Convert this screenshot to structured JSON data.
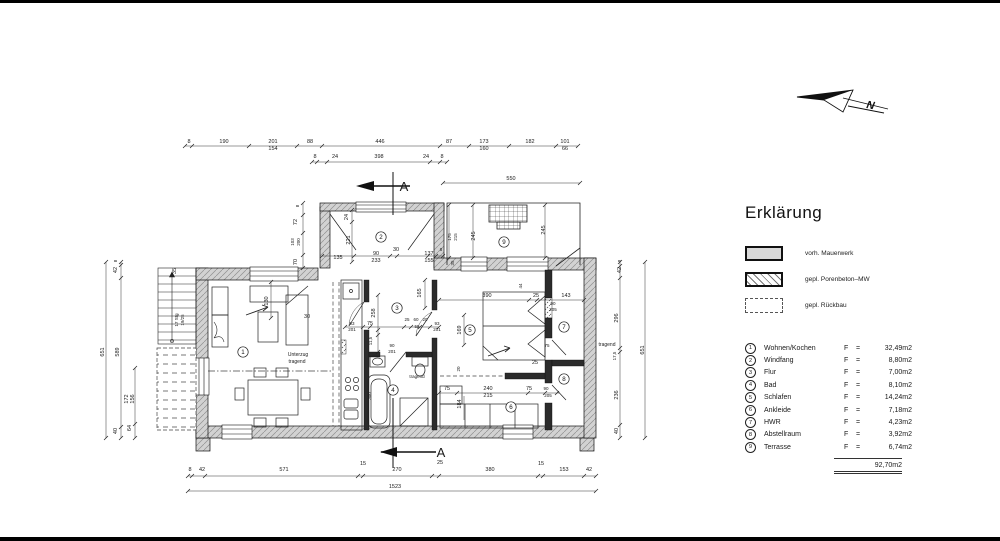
{
  "legend": {
    "title": "Erklärung",
    "items": [
      {
        "key": "vorh-mauerwerk",
        "style": "solid",
        "label": "vorh. Mauerwerk"
      },
      {
        "key": "gepl-porenbeton",
        "style": "hatched",
        "label": "gepl. Porenbeton–MW"
      },
      {
        "key": "gepl-rueckbau",
        "style": "dashed",
        "label": "gepl. Rückbau"
      }
    ],
    "rooms": [
      {
        "num": "1",
        "name": "Wohnen/Kochen",
        "f": "F",
        "eq": "=",
        "area": "32,49m2"
      },
      {
        "num": "2",
        "name": "Windfang",
        "f": "F",
        "eq": "=",
        "area": "8,80m2"
      },
      {
        "num": "3",
        "name": "Flur",
        "f": "F",
        "eq": "=",
        "area": "7,00m2"
      },
      {
        "num": "4",
        "name": "Bad",
        "f": "F",
        "eq": "=",
        "area": "8,10m2"
      },
      {
        "num": "5",
        "name": "Schlafen",
        "f": "F",
        "eq": "=",
        "area": "14,24m2"
      },
      {
        "num": "6",
        "name": "Ankleide",
        "f": "F",
        "eq": "=",
        "area": "7,18m2"
      },
      {
        "num": "7",
        "name": "HWR",
        "f": "F",
        "eq": "=",
        "area": "4,23m2"
      },
      {
        "num": "8",
        "name": "Abstellraum",
        "f": "F",
        "eq": "=",
        "area": "3,92m2"
      },
      {
        "num": "9",
        "name": "Terrasse",
        "f": "F",
        "eq": "=",
        "area": "6,74m2"
      }
    ],
    "total": "92,70m2"
  },
  "north": {
    "label": "N"
  },
  "plan": {
    "room_markers": [
      {
        "n": "1",
        "x": 243,
        "y": 352
      },
      {
        "n": "2",
        "x": 381,
        "y": 237
      },
      {
        "n": "3",
        "x": 397,
        "y": 308
      },
      {
        "n": "4",
        "x": 393,
        "y": 390
      },
      {
        "n": "5",
        "x": 470,
        "y": 330
      },
      {
        "n": "6",
        "x": 511,
        "y": 407
      },
      {
        "n": "7",
        "x": 564,
        "y": 327
      },
      {
        "n": "8",
        "x": 564,
        "y": 379
      },
      {
        "n": "9",
        "x": 504,
        "y": 242
      }
    ],
    "labels": [
      {
        "t": "8",
        "x": 189,
        "y": 143
      },
      {
        "t": "190",
        "x": 224,
        "y": 143
      },
      {
        "t": "201",
        "x": 273,
        "y": 143
      },
      {
        "t": "154",
        "x": 273,
        "y": 150
      },
      {
        "t": "88",
        "x": 310,
        "y": 143
      },
      {
        "t": "446",
        "x": 380,
        "y": 143
      },
      {
        "t": "87",
        "x": 449,
        "y": 143
      },
      {
        "t": "173",
        "x": 484,
        "y": 143
      },
      {
        "t": "160",
        "x": 484,
        "y": 150
      },
      {
        "t": "182",
        "x": 530,
        "y": 143
      },
      {
        "t": "101",
        "x": 565,
        "y": 143
      },
      {
        "t": "66",
        "x": 565,
        "y": 150
      },
      {
        "t": "8",
        "x": 315,
        "y": 158
      },
      {
        "t": "24",
        "x": 335,
        "y": 158
      },
      {
        "t": "398",
        "x": 379,
        "y": 158
      },
      {
        "t": "24",
        "x": 426,
        "y": 158
      },
      {
        "t": "8",
        "x": 442,
        "y": 158
      },
      {
        "t": "550",
        "x": 511,
        "y": 180
      },
      {
        "t": "8",
        "x": 190,
        "y": 471
      },
      {
        "t": "42",
        "x": 202,
        "y": 471
      },
      {
        "t": "571",
        "x": 284,
        "y": 471
      },
      {
        "t": "15",
        "x": 363,
        "y": 465
      },
      {
        "t": "270",
        "x": 397,
        "y": 471
      },
      {
        "t": "25",
        "x": 440,
        "y": 464
      },
      {
        "t": "380",
        "x": 490,
        "y": 471
      },
      {
        "t": "15",
        "x": 541,
        "y": 465
      },
      {
        "t": "153",
        "x": 564,
        "y": 471
      },
      {
        "t": "42",
        "x": 589,
        "y": 471
      },
      {
        "t": "1523",
        "x": 395,
        "y": 488
      },
      {
        "t": "651",
        "x": 104,
        "y": 352,
        "r": -90
      },
      {
        "t": "42",
        "x": 117,
        "y": 270,
        "r": -90
      },
      {
        "t": "8",
        "x": 117,
        "y": 261,
        "r": -90,
        "s": 4.5
      },
      {
        "t": "589",
        "x": 119,
        "y": 352,
        "r": -90
      },
      {
        "t": "40",
        "x": 117,
        "y": 431,
        "r": -90
      },
      {
        "t": "172",
        "x": 128,
        "y": 399,
        "r": -90
      },
      {
        "t": "156",
        "x": 134,
        "y": 399,
        "r": -90
      },
      {
        "t": "64",
        "x": 131,
        "y": 428,
        "r": -90
      },
      {
        "t": "35",
        "x": 176,
        "y": 271,
        "r": -90
      },
      {
        "t": "17 Stg",
        "x": 178,
        "y": 320,
        "r": -90,
        "s": 4.5
      },
      {
        "t": "19/25",
        "x": 184,
        "y": 320,
        "r": -90,
        "s": 4.5
      },
      {
        "t": "42",
        "x": 621,
        "y": 270,
        "r": -90
      },
      {
        "t": "8",
        "x": 621,
        "y": 261,
        "r": -90,
        "s": 4.5
      },
      {
        "t": "296",
        "x": 618,
        "y": 318,
        "r": -90
      },
      {
        "t": "17,5",
        "x": 616,
        "y": 356,
        "r": -90,
        "s": 4.5
      },
      {
        "t": "236",
        "x": 618,
        "y": 395,
        "r": -90
      },
      {
        "t": "40",
        "x": 618,
        "y": 431,
        "r": -90
      },
      {
        "t": "651",
        "x": 644,
        "y": 350,
        "r": -90
      },
      {
        "t": "tragend",
        "x": 607,
        "y": 346,
        "s": 5
      },
      {
        "t": "8",
        "x": 299,
        "y": 206,
        "r": -90,
        "s": 4.5
      },
      {
        "t": "72",
        "x": 297,
        "y": 222,
        "r": -90
      },
      {
        "t": "103",
        "x": 294,
        "y": 242,
        "r": -90,
        "s": 4.5
      },
      {
        "t": "200",
        "x": 300,
        "y": 242,
        "r": -90,
        "s": 4.5
      },
      {
        "t": "70",
        "x": 297,
        "y": 262,
        "r": -90
      },
      {
        "t": "24",
        "x": 348,
        "y": 217,
        "r": -90
      },
      {
        "t": "221",
        "x": 350,
        "y": 240,
        "r": -90
      },
      {
        "t": "135",
        "x": 338,
        "y": 259
      },
      {
        "t": "90",
        "x": 376,
        "y": 255
      },
      {
        "t": "233",
        "x": 376,
        "y": 262
      },
      {
        "t": "30",
        "x": 396,
        "y": 251
      },
      {
        "t": "137",
        "x": 429,
        "y": 255
      },
      {
        "t": "155",
        "x": 429,
        "y": 262
      },
      {
        "t": "8",
        "x": 441,
        "y": 251,
        "s": 4.5
      },
      {
        "t": "175",
        "x": 451,
        "y": 237,
        "r": -90,
        "s": 4.5
      },
      {
        "t": "215",
        "x": 457,
        "y": 237,
        "r": -90,
        "s": 4.5
      },
      {
        "t": "245",
        "x": 475,
        "y": 236,
        "r": -90
      },
      {
        "t": "245",
        "x": 545,
        "y": 230,
        "r": -90
      },
      {
        "t": "35",
        "x": 454,
        "y": 263,
        "r": -90,
        "s": 4.5
      },
      {
        "t": "44",
        "x": 522,
        "y": 286,
        "r": -90,
        "s": 4.5
      },
      {
        "t": "130",
        "x": 268,
        "y": 301,
        "r": -90
      },
      {
        "t": "30",
        "x": 307,
        "y": 318
      },
      {
        "t": "93",
        "x": 352,
        "y": 325,
        "s": 4.5
      },
      {
        "t": "201",
        "x": 352,
        "y": 331,
        "s": 4.5
      },
      {
        "t": "75",
        "x": 370,
        "y": 325
      },
      {
        "t": "258",
        "x": 375,
        "y": 313,
        "r": -90
      },
      {
        "t": "11,5",
        "x": 372,
        "y": 341,
        "r": -90,
        "s": 4.5
      },
      {
        "t": "165",
        "x": 421,
        "y": 293,
        "r": -90
      },
      {
        "t": "25",
        "x": 407,
        "y": 321,
        "s": 4.5
      },
      {
        "t": "60",
        "x": 416,
        "y": 321,
        "s": 4.5
      },
      {
        "t": "20",
        "x": 425,
        "y": 321,
        "s": 4.5
      },
      {
        "t": "55",
        "x": 417,
        "y": 328,
        "s": 4.5
      },
      {
        "t": "93",
        "x": 437,
        "y": 325,
        "s": 4.5
      },
      {
        "t": "201",
        "x": 437,
        "y": 331,
        "s": 4.5
      },
      {
        "t": "90",
        "x": 392,
        "y": 347,
        "s": 4.5
      },
      {
        "t": "201",
        "x": 392,
        "y": 353,
        "s": 4.5
      },
      {
        "t": "169",
        "x": 461,
        "y": 330,
        "r": -90
      },
      {
        "t": "Unterzug",
        "x": 298,
        "y": 356,
        "s": 5
      },
      {
        "t": "tragend",
        "x": 297,
        "y": 363,
        "s": 5
      },
      {
        "t": "300",
        "x": 371,
        "y": 396,
        "r": -90,
        "s": 4.5
      },
      {
        "t": "tragend",
        "x": 417,
        "y": 378,
        "s": 4.5
      },
      {
        "t": "20",
        "x": 460,
        "y": 369,
        "r": -90,
        "s": 4.5
      },
      {
        "t": "390",
        "x": 487,
        "y": 297
      },
      {
        "t": "25",
        "x": 536,
        "y": 297
      },
      {
        "t": "143",
        "x": 566,
        "y": 297
      },
      {
        "t": "90",
        "x": 553,
        "y": 305,
        "s": 4.5
      },
      {
        "t": "205",
        "x": 553,
        "y": 311,
        "s": 4.5
      },
      {
        "t": "75",
        "x": 547,
        "y": 347,
        "s": 4.5
      },
      {
        "t": "25",
        "x": 535,
        "y": 364
      },
      {
        "t": "75",
        "x": 447,
        "y": 390
      },
      {
        "t": "240",
        "x": 488,
        "y": 390
      },
      {
        "t": "215",
        "x": 488,
        "y": 397
      },
      {
        "t": "75",
        "x": 529,
        "y": 390
      },
      {
        "t": "90",
        "x": 546,
        "y": 390,
        "s": 4.5
      },
      {
        "t": "205",
        "x": 548,
        "y": 397,
        "s": 4.5
      },
      {
        "t": "184",
        "x": 461,
        "y": 404,
        "r": -90
      },
      {
        "t": "A",
        "x": 404,
        "y": 191,
        "s": 13
      },
      {
        "t": "A",
        "x": 441,
        "y": 457,
        "s": 13
      }
    ]
  }
}
